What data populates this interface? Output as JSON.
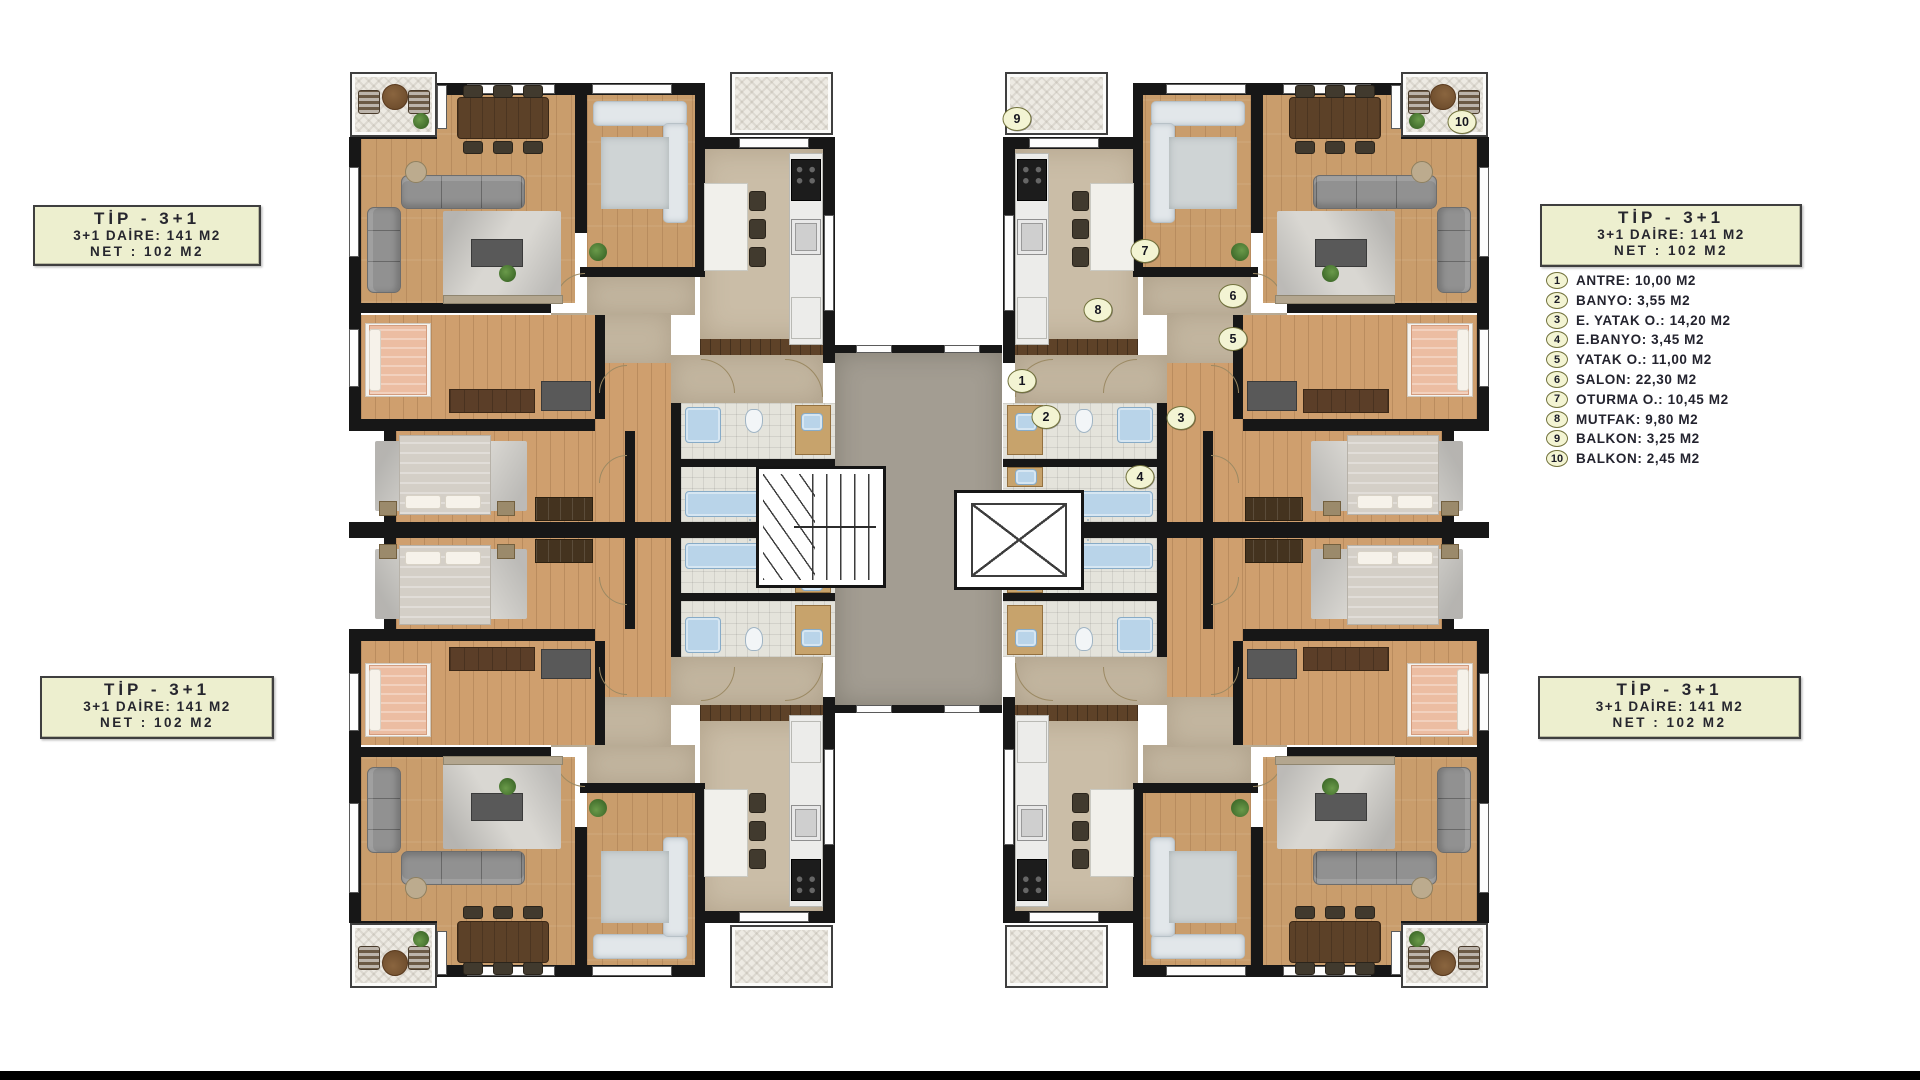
{
  "page": {
    "background": "#ffffff",
    "bottom_bar_color": "#000000"
  },
  "unit_label": {
    "title": "TİP - 3+1",
    "gross": "3+1 DAİRE: 141 M2",
    "net": "NET : 102 M2"
  },
  "legend": {
    "items": [
      {
        "n": "1",
        "label": "ANTRE: 10,00 M2"
      },
      {
        "n": "2",
        "label": "BANYO: 3,55 M2"
      },
      {
        "n": "3",
        "label": "E. YATAK O.: 14,20 M2"
      },
      {
        "n": "4",
        "label": "E.BANYO: 3,45 M2"
      },
      {
        "n": "5",
        "label": "YATAK O.: 11,00 M2"
      },
      {
        "n": "6",
        "label": "SALON: 22,30 M2"
      },
      {
        "n": "7",
        "label": "OTURMA O.: 10,45 M2"
      },
      {
        "n": "8",
        "label": "MUTFAK: 9,80 M2"
      },
      {
        "n": "9",
        "label": "BALKON: 3,25 M2"
      },
      {
        "n": "10",
        "label": "BALKON: 2,45 M2"
      }
    ]
  },
  "palette": {
    "wall": "#171717",
    "wood": "#c99d6c",
    "wood2": "#cf9f6e",
    "kitchen_floor": "#cabda7",
    "tan": "#c3b6a0",
    "corridor": "#a39d92",
    "label_box_bg": "#edefcf",
    "marker_bg": "#f3f4d3"
  }
}
